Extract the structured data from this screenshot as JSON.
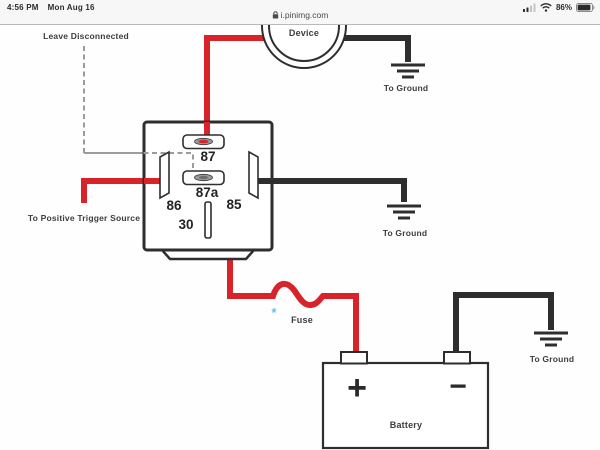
{
  "status_bar": {
    "time": "4:56 PM",
    "date": "Mon Aug 16",
    "url": "i.pinimg.com",
    "battery_percent": "86%"
  },
  "diagram": {
    "labels": {
      "leave_disconnected": "Leave Disconnected",
      "device": "Device",
      "to_ground_top": "To Ground",
      "to_ground_middle": "To Ground",
      "to_ground_bottom": "To Ground",
      "to_positive_trigger": "To Positive Trigger Source",
      "fuse": "Fuse",
      "fuse_asterisk": "*",
      "battery": "Battery",
      "battery_positive": "+",
      "battery_negative": "−"
    },
    "pins": {
      "p87": "87",
      "p87a": "87a",
      "p86": "86",
      "p85": "85",
      "p30": "30"
    }
  },
  "colors": {
    "wire_red": "#d8232a",
    "wire_black": "#2e2e2e",
    "dashed_gray": "#9c9c9c",
    "label_gray": "#3d3d3d",
    "fuse_asterisk_blue": "#5fc3ea",
    "statusbar_bg": "#f7f7f7"
  }
}
